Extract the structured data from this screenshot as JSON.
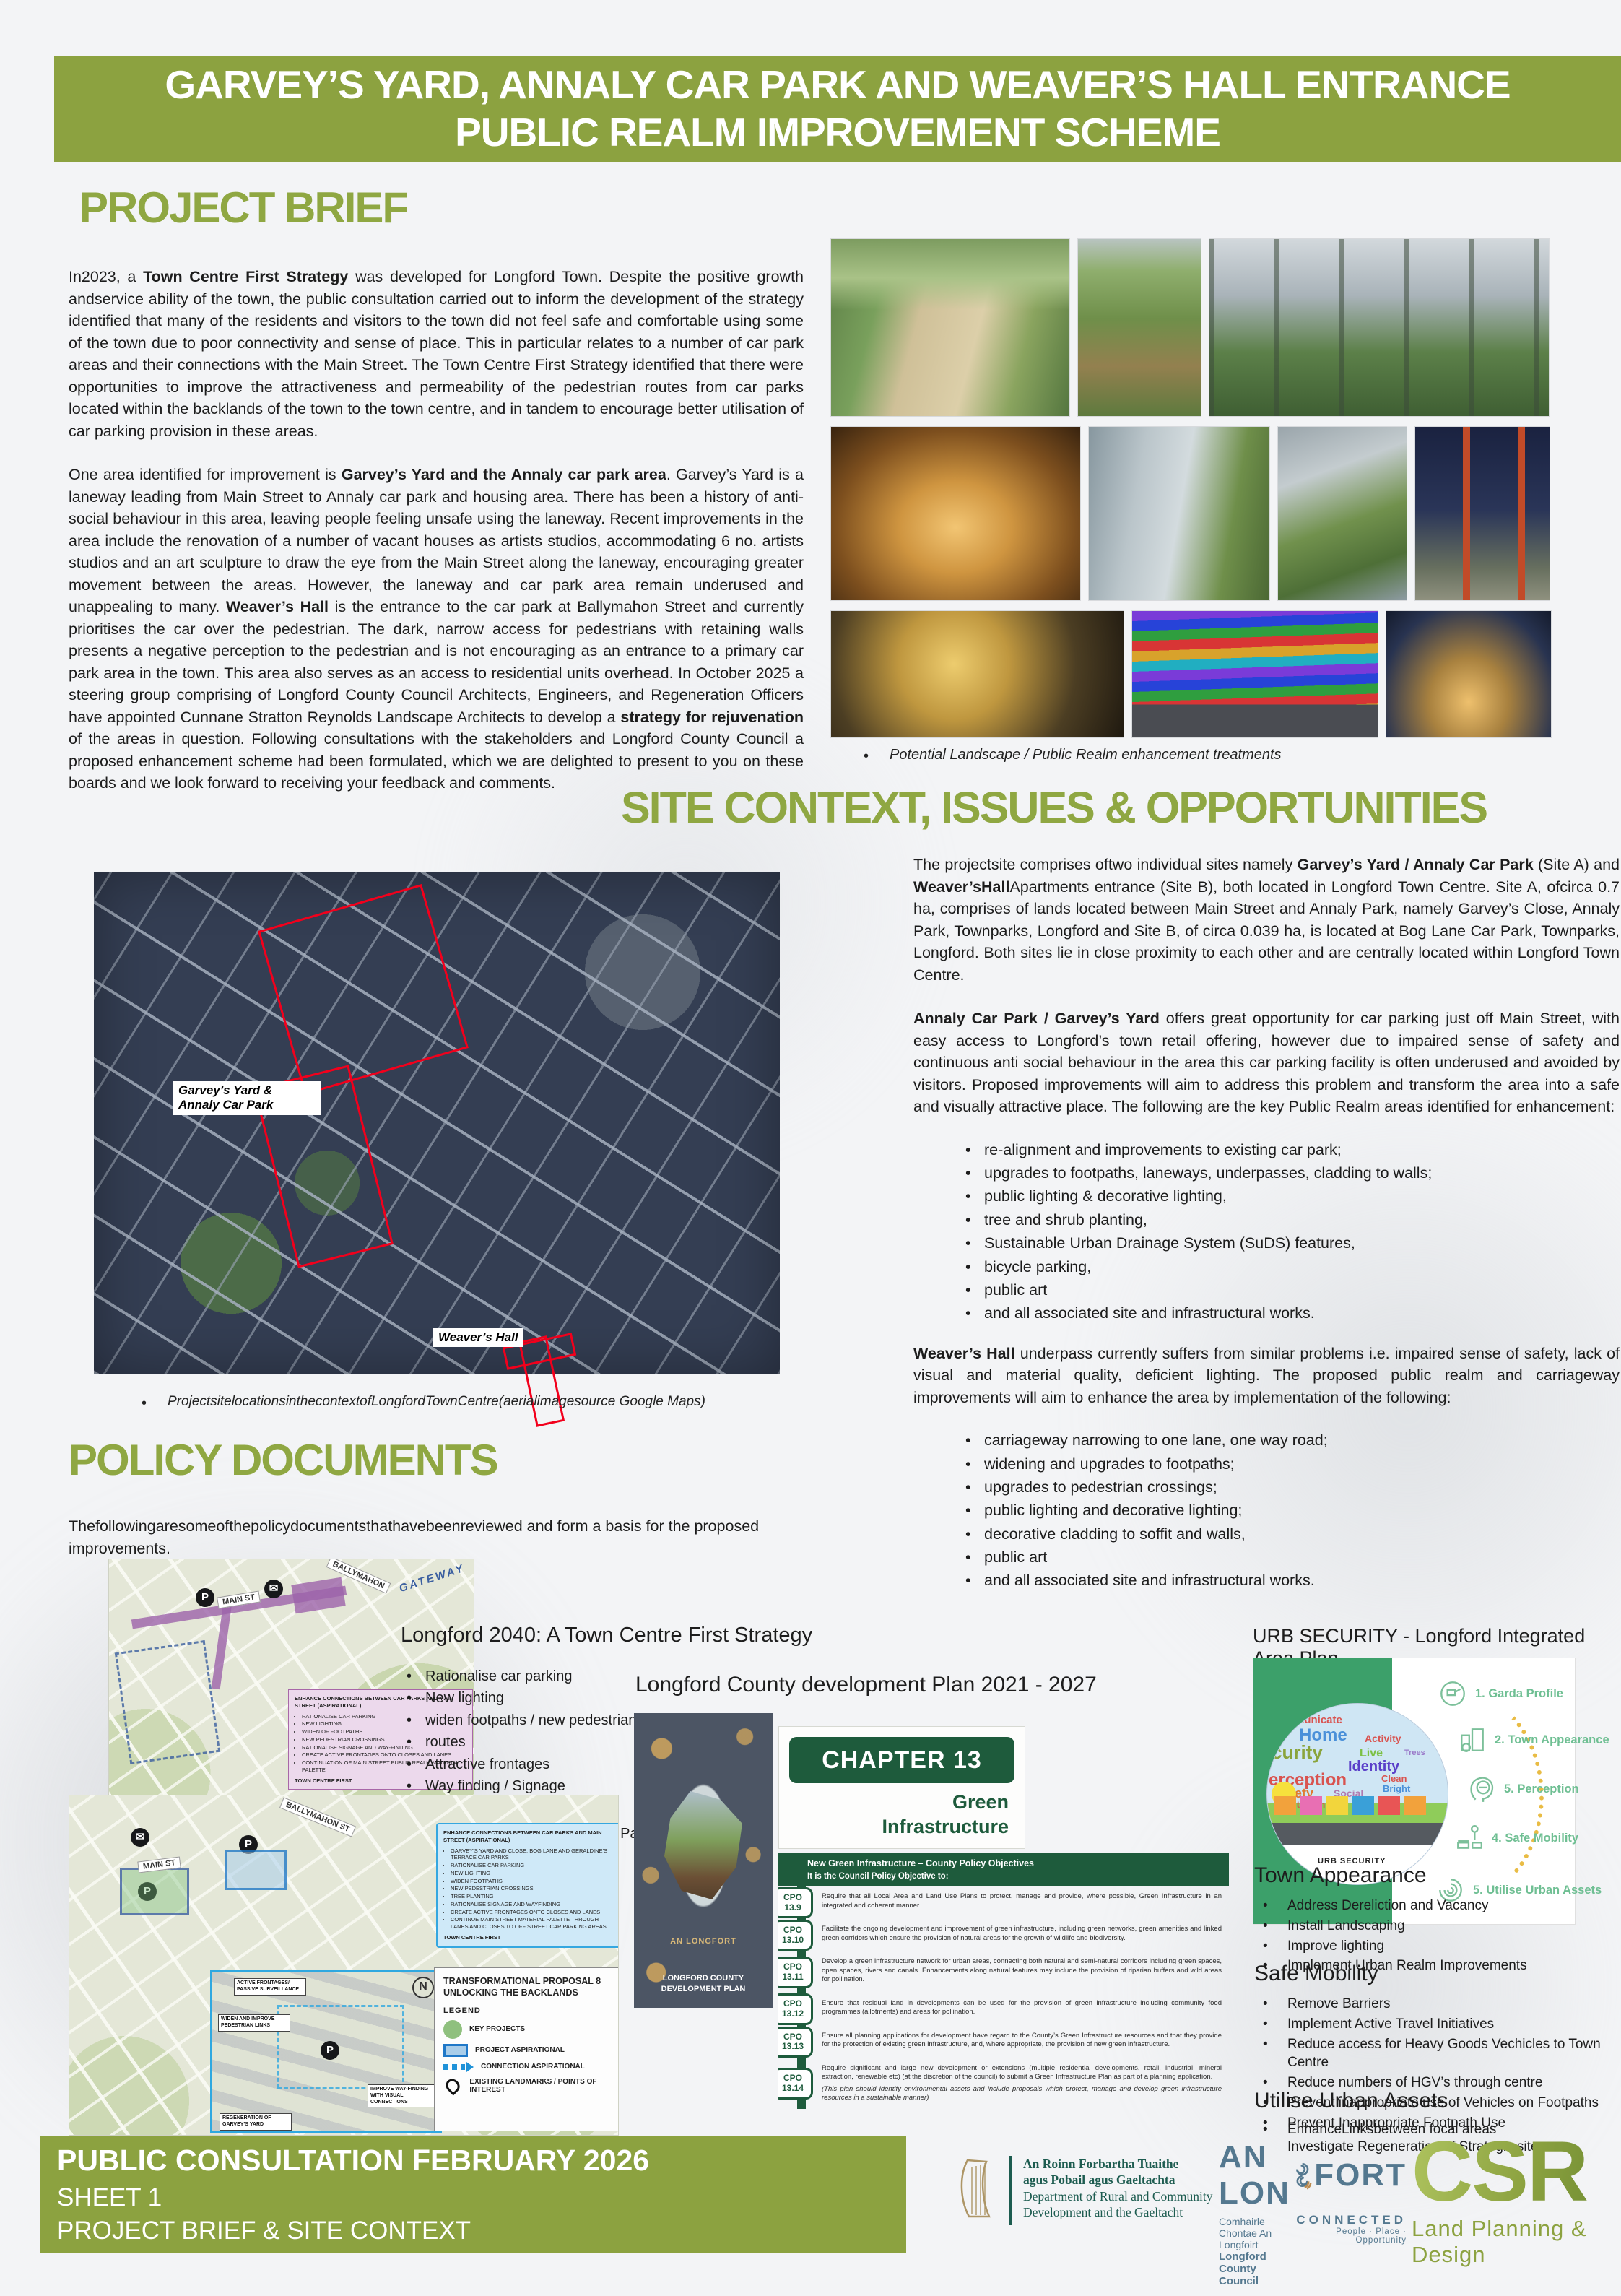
{
  "header": {
    "title_line1": "GARVEY’S YARD, ANNALY CAR PARK AND WEAVER’S HALL ENTRANCE",
    "title_line2": "PUBLIC REALM IMPROVEMENT SCHEME"
  },
  "project_brief": {
    "heading": "PROJECT BRIEF",
    "para1": [
      {
        "t": "In2023, a ",
        "b": false
      },
      {
        "t": "Town Centre First Strategy",
        "b": true
      },
      {
        "t": " was developed for Longford Town. Despite the positive growth andservice ability of the town, the public consultation carried out to inform the development of the strategy identified that many of the residents and visitors to the town did not feel safe and comfortable using some of the town due to poor connectivity and sense of place. This in particular relates to a number of car park areas and their connections with the Main Street. The Town Centre First Strategy identified that there were opportunities to improve the attractiveness and permeability of the pedestrian routes from car parks located within the backlands of the town to the town centre, and in tandem to encourage better utilisation of car parking provision in these areas.",
        "b": false
      }
    ],
    "para2": [
      {
        "t": "One area identified for improvement is ",
        "b": false
      },
      {
        "t": "Garvey’s Yard and the Annaly car park area",
        "b": true
      },
      {
        "t": ". Garvey’s Yard is a laneway leading from Main Street to Annaly car park and housing area. There has been a history of anti-social behaviour in this area, leaving people feeling unsafe using the laneway. Recent improvements in the area include the renovation of a number of vacant houses as artists studios, accommodating 6 no. artists studios and an art sculpture to draw the eye from the Main Street along the laneway, encouraging greater movement between the areas. However, the laneway and car park area remain underused and unappealing to many. ",
        "b": false
      },
      {
        "t": "Weaver’s Hall",
        "b": true
      },
      {
        "t": " is the entrance to the car park at Ballymahon Street and currently prioritises the car over the pedestrian. The dark, narrow access for pedestrians with retaining walls presents a negative perception to the pedestrian and is not encouraging as an entrance to a primary car park area in the town. This area also serves as an access to residential units overhead. In October 2025 a steering group comprising of Longford County Council Architects, Engineers, and Regeneration Officers have appointed Cunnane Stratton Reynolds Landscape Architects to develop a ",
        "b": false
      },
      {
        "t": "strategy for rejuvenation",
        "b": true
      },
      {
        "t": " of the areas in question. Following consultations with the stakeholders and Longford County Council a proposed enhancement scheme had been formulated, which we are delighted to present to you on these boards and we look forward to receiving your feedback and comments.",
        "b": false
      }
    ]
  },
  "photo_caption": "Potential Landscape / Public Realm enhancement treatments",
  "site_context": {
    "heading": "SITE CONTEXT, ISSUES & OPPORTUNITIES",
    "para1": [
      {
        "t": "The projectsite comprises oftwo individual sites namely ",
        "b": false
      },
      {
        "t": "Garvey’s Yard / Annaly Car Park",
        "b": true
      },
      {
        "t": " (Site A) and ",
        "b": false
      },
      {
        "t": "Weaver’sHall",
        "b": true
      },
      {
        "t": "Apartments entrance (Site B), both located in Longford Town Centre. Site A, ofcirca 0.7 ha, comprises of lands located between Main Street and Annaly Park, namely Garvey’s Close, Annaly Park, Townparks, Longford and Site B, of circa 0.039 ha, is located at Bog Lane Car Park, Townparks, Longford. Both sites lie in close proximity to each other and are centrally located within Longford Town Centre.",
        "b": false
      }
    ],
    "para2": [
      {
        "t": "Annaly Car Park / Garvey’s Yard",
        "b": true
      },
      {
        "t": " offers great opportunity for car parking just off Main Street, with easy access to Longford’s town retail offering, however due to impaired sense of safety and continuous anti social behaviour in the area this car parking facility is often underused and avoided by visitors. Proposed improvements will aim to address this problem and transform the area into a safe and visually attractive place. The following are the key Public Realm areas identified for enhancement:",
        "b": false
      }
    ],
    "bullets1": [
      "re-alignment and improvements to existing car park;",
      "upgrades to footpaths, laneways, underpasses, cladding to walls;",
      "public lighting & decorative lighting,",
      "tree and shrub planting,",
      "Sustainable Urban Drainage System (SuDS) features,",
      "bicycle parking,",
      "public art",
      "and all associated site and infrastructural works."
    ],
    "para3": [
      {
        "t": "Weaver’s Hall",
        "b": true
      },
      {
        "t": " underpass currently suffers from similar problems i.e. impaired sense of safety, lack of visual and material quality, deficient lighting. The proposed public realm and carriageway improvements will aim to enhance the area by implementation of the following:",
        "b": false
      }
    ],
    "bullets2": [
      "carriageway narrowing to one lane, one way road;",
      "widening and upgrades to footpaths;",
      "upgrades to pedestrian crossings;",
      "public lighting and decorative lighting;",
      "decorative cladding to soffit and walls,",
      "public art",
      "and all associated site and infrastructural works."
    ]
  },
  "aerial_map": {
    "label_site_a": "Garvey’s Yard & Annaly Car Park",
    "label_site_b": "Weaver’s Hall",
    "caption": "ProjectsitelocationsinthecontextofLongfordTownCentre(aerialimagesource Google Maps)"
  },
  "policy": {
    "heading": "POLICY DOCUMENTS",
    "intro": "Thefollowingaresomeofthepolicydocumentsthathavebeenreviewed and form a basis for the proposed improvements."
  },
  "longford2040": {
    "heading": "Longford 2040: A Town Centre First Strategy",
    "bullets": [
      "Rationalise car parking",
      "New lighting",
      "widen footpaths / new pedestrian access",
      "routes",
      "Attractive frontages",
      "Way finding / Signage",
      "Tree planting",
      "Add greenery"
    ],
    "continuation": "Continue Main Street Material Palette"
  },
  "map1": {
    "street_labels": [
      "MAIN ST",
      "BALLYMAHON",
      "GATEWAY"
    ],
    "pink_box": {
      "title": "ENHANCE CONNECTIONS BETWEEN CAR PARKS AND MAIN STREET (ASPIRATIONAL)",
      "bullets": [
        "RATIONALISE CAR PARKING",
        "NEW LIGHTING",
        "WIDEN OF FOOTPATHS",
        "NEW PEDESTRIAN CROSSINGS",
        "RATIONALISE SIGNAGE AND WAY-FINDING",
        "CREATE ACTIVE FRONTAGES ONTO CLOSES AND LANES",
        "CONTINUATION OF MAIN STREET PUBLIC REALM MATERIAL PALETTE"
      ],
      "footer": "TOWN CENTRE FIRST"
    }
  },
  "map2": {
    "street_labels": [
      "MAIN ST",
      "BALLYMAHON ST"
    ],
    "blue_box": {
      "title": "ENHANCE CONNECTIONS BETWEEN CAR PARKS AND MAIN STREET (ASPIRATIONAL)",
      "bullets": [
        "GARVEY’S YARD AND CLOSE, BOG LANE AND GERALDINE’S TERRACE CAR PARKS",
        "RATIONALISE CAR PARKING",
        "NEW LIGHTING",
        "WIDEN FOOTPATHS",
        "NEW PEDESTRIAN CROSSINGS",
        "TREE PLANTING",
        "RATIONALISE SIGNAGE AND WAYFINDING",
        "CREATE ACTIVE FRONTAGES ONTO CLOSES AND LANES",
        "CONTINUE MAIN STREET MATERIAL PALETTE THROUGH LANES AND CLOSES TO OFF STREET CAR PARKING AREAS"
      ],
      "footer": "TOWN CENTRE FIRST"
    },
    "legend": {
      "title1": "TRANSFORMATIONAL PROPOSAL 8",
      "title2": "UNLOCKING THE BACKLANDS",
      "label": "LEGEND",
      "items": [
        "KEY PROJECTS",
        "PROJECT ASPIRATIONAL",
        "CONNECTION ASPIRATIONAL",
        "EXISTING LANDMARKS / POINTS OF INTEREST"
      ]
    },
    "callouts": [
      "ACTIVE FRONTAGES/ PASSIVE SURVEILLANCE",
      "WIDEN AND IMPROVE PEDESTRIAN LINKS",
      "IMPROVE WAY-FINDING WITH VISUAL CONNECTIONS",
      "REGENERATION OF GARVEY’S YARD"
    ]
  },
  "cdp": {
    "heading": "Longford County development Plan 2021 - 2027",
    "cover_brand": "AN LONGFORT",
    "cover_title": "LONGFORD COUNTY DEVELOPMENT PLAN",
    "chapter": "CHAPTER 13",
    "chapter_title_1": "Green",
    "chapter_title_2": "Infrastructure",
    "table": {
      "header1": "New Green Infrastructure – County Policy Objectives",
      "header2": "It is the Council Policy Objective to:",
      "rows": [
        {
          "tag_top": "CPO",
          "tag_num": "13.9",
          "text": "Require that all Local Area and Land Use Plans to protect, manage and provide, where possible, Green Infrastructure in an integrated and coherent manner.",
          "note": ""
        },
        {
          "tag_top": "CPO",
          "tag_num": "13.10",
          "text": "Facilitate the ongoing development and improvement of green infrastructure, including green networks, green amenities and linked green corridors which ensure the provision of natural areas for the growth of wildlife and biodiversity.",
          "note": ""
        },
        {
          "tag_top": "CPO",
          "tag_num": "13.11",
          "text": "Develop a green infrastructure network for urban areas, connecting both natural and semi-natural corridors including green spaces, open spaces, rivers and canals. Enhancements along natural features may include the provision of riparian buffers and wild areas for pollination.",
          "note": ""
        },
        {
          "tag_top": "CPO",
          "tag_num": "13.12",
          "text": "Ensure that residual land in developments can be used for the provision of green infrastructure including community food programmes (allotments) and areas for pollination.",
          "note": ""
        },
        {
          "tag_top": "CPO",
          "tag_num": "13.13",
          "text": "Ensure all planning applications for development have regard to the County’s Green Infrastructure resources and that they provide for the protection of existing green infrastructure, and, where appropriate, the provision of new green infrastructure.",
          "note": ""
        },
        {
          "tag_top": "CPO",
          "tag_num": "13.14",
          "text": "Require significant and large new development or extensions (multiple residential developments, retail, industrial, mineral extraction, renewable etc) (at the discretion of the council) to submit a Green Infrastructure Plan as part of a planning application.",
          "note": "(This plan should identify environmental assets and include proposals which protect, manage and develop green infrastructure resources in a sustainable manner)"
        }
      ]
    }
  },
  "urb": {
    "heading": "URB SECURITY - Longford Integrated Area Plan",
    "items": [
      "1. Garda Profile",
      "2. Town Appearance",
      "5. Perception",
      "4. Safe Mobility",
      "5. Utilise Urban Assets"
    ],
    "cloud_words": [
      "municate",
      "Home",
      "Activity",
      "curity",
      "Live",
      "Trees",
      "Identity",
      "erception",
      "Clean",
      "Bright",
      "Safety",
      "Social",
      "Entertainment"
    ],
    "logo": "URB SECURITY"
  },
  "town_appearance": {
    "heading": "Town Appearance",
    "bullets": [
      "Address Dereliction and Vacancy",
      "Install Landscaping",
      "Improve lighting",
      "Implement Urban Realm Improvements"
    ]
  },
  "safe_mobility": {
    "heading": "Safe Mobility",
    "bullets": [
      "Remove Barriers",
      "Implement Active Travel Initiatives",
      "Reduce access for Heavy Goods Vechicles to Town Centre",
      "Reduce numbers of HGV’s through centre",
      "Prevent inappropriate use of Vehicles on Footpaths",
      "Prevent Inappropriate Footpath Use"
    ]
  },
  "utilise": {
    "heading": "Utilise Urban Assets",
    "bullet1": "EnhanceLinksbetween focal areas",
    "line2": "Investigate Regeneration of Strategic sites"
  },
  "footer": {
    "line1": "PUBLIC CONSULTATION FEBRUARY 2026",
    "line2": "SHEET 1",
    "line3": "PROJECT BRIEF & SITE CONTEXT"
  },
  "logos": {
    "dept": {
      "ga1": "An Roinn Forbartha Tuaithe",
      "ga2": "agus Pobail agus Gaeltachta",
      "en1": "Department of Rural and Community",
      "en2": "Development and the Gaeltacht"
    },
    "longford": {
      "name_left": "AN LON",
      "name_right": "FORT",
      "irish": "Comhairle Chontae An Longfoirt",
      "english": "Longford County Council",
      "connected": "CONNECTED",
      "tagline": "People · Place · Opportunity"
    },
    "csr": {
      "name": "CSR",
      "tagline": "Land Planning & Design"
    }
  },
  "colors": {
    "accent_green": "#8ca240",
    "heading_green": "#8fa742",
    "table_green": "#1e5b3c",
    "urb_green": "#3ca06a",
    "site_outline_red": "#f2001c"
  }
}
